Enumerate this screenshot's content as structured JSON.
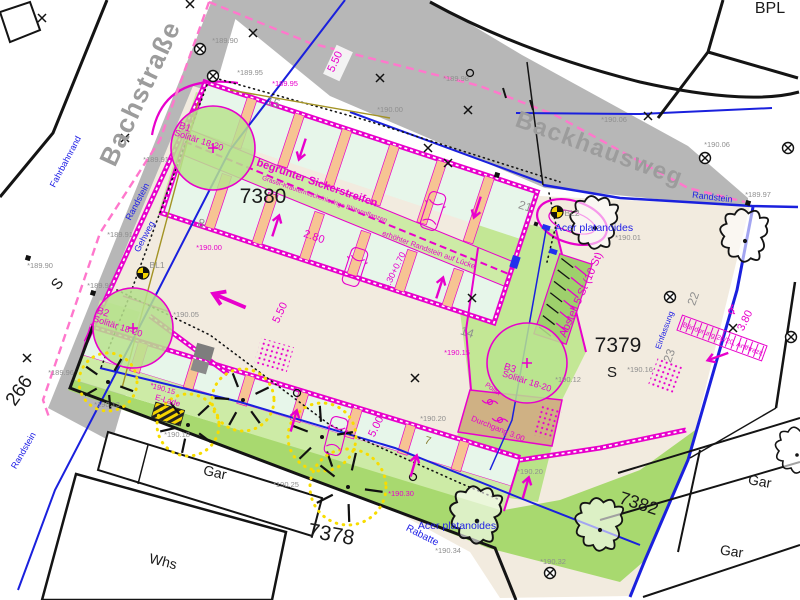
{
  "plan": {
    "colors": {
      "magenta": "#e800cc",
      "pink_boundary": "#ff77cc",
      "blue": "#1a20dd",
      "road_gray": "#b7b7b7",
      "site_beige": "#f2ebdf",
      "green_light": "#cdeba6",
      "green_mid": "#a8d96f",
      "stall_mint": "#e7f6ea",
      "peach": "#f6c493",
      "tan": "#cfb184",
      "tree_yellow": "#f7dc00"
    },
    "labels": {
      "streets": [
        {
          "n": "street-label-bachstrasse",
          "t": "Bachstraße",
          "x": 148,
          "y": 97,
          "r": -65,
          "s": 26
        },
        {
          "n": "street-label-backhausweg",
          "t": "Backhausweg",
          "x": 597,
          "y": 156,
          "r": 20,
          "s": 24
        }
      ],
      "blue_labels": [
        {
          "n": "label-fahrbahnrand",
          "t": "Fahrbahnrand",
          "x": 68,
          "y": 163,
          "r": -62,
          "s": 9
        },
        {
          "n": "label-randstein-left",
          "t": "Randstein",
          "x": 140,
          "y": 203,
          "r": -62,
          "s": 9
        },
        {
          "n": "label-gehweg",
          "t": "Gehweg",
          "x": 147,
          "y": 238,
          "r": -62,
          "s": 9
        },
        {
          "n": "label-randstein-sw",
          "t": "Randstein",
          "x": 26,
          "y": 452,
          "r": -60,
          "s": 9
        },
        {
          "n": "label-randstein-ne",
          "t": "Randstein",
          "x": 712,
          "y": 200,
          "r": 7,
          "s": 9
        },
        {
          "n": "label-rabatte",
          "t": "Rabatte",
          "x": 421,
          "y": 538,
          "r": 27,
          "s": 10
        },
        {
          "n": "label-acer-top",
          "t": "Acer platanoides",
          "x": 594,
          "y": 231,
          "r": 0,
          "s": 10.5
        },
        {
          "n": "label-acer-bottom",
          "t": "Acer platanoides",
          "x": 457,
          "y": 529,
          "r": 0,
          "s": 10.5
        },
        {
          "n": "label-einfassung",
          "t": "Einfassung",
          "x": 667,
          "y": 331,
          "r": -70,
          "s": 8
        }
      ],
      "parcel_labels": [
        {
          "n": "parcel-7380",
          "t": "7380",
          "x": 263,
          "y": 203,
          "r": 0,
          "s": 21
        },
        {
          "n": "parcel-7379",
          "t": "7379",
          "x": 618,
          "y": 352,
          "r": 0,
          "s": 21
        },
        {
          "n": "parcel-7378",
          "t": "7378",
          "x": 330,
          "y": 541,
          "r": 10,
          "s": 21
        },
        {
          "n": "parcel-7382",
          "t": "7382",
          "x": 637,
          "y": 509,
          "r": 18,
          "s": 18
        },
        {
          "n": "label-bpl",
          "t": "BPL",
          "x": 770,
          "y": 13,
          "r": 0,
          "s": 16
        },
        {
          "n": "label-s-7379",
          "t": "S",
          "x": 612,
          "y": 377,
          "r": 0,
          "s": 15
        },
        {
          "n": "label-s-street",
          "t": "S",
          "x": 61,
          "y": 287,
          "r": -50,
          "s": 15
        },
        {
          "n": "parcel-266",
          "t": "266",
          "x": 24,
          "y": 394,
          "r": -55,
          "s": 19
        },
        {
          "n": "building-whs",
          "t": "Whs",
          "x": 162,
          "y": 566,
          "r": 14,
          "s": 14
        },
        {
          "n": "building-gar-1",
          "t": "Gar",
          "x": 214,
          "y": 477,
          "r": 12,
          "s": 14
        },
        {
          "n": "building-gar-2",
          "t": "Gar",
          "x": 759,
          "y": 486,
          "r": 10,
          "s": 14
        },
        {
          "n": "building-gar-3",
          "t": "Gar",
          "x": 731,
          "y": 556,
          "r": 8,
          "s": 14
        }
      ],
      "stall_numbers": [
        {
          "t": "15",
          "x": 272,
          "y": 106,
          "r": 18,
          "s": 12
        },
        {
          "t": "8",
          "x": 200,
          "y": 227,
          "r": 18,
          "s": 12
        },
        {
          "t": "21",
          "x": 524,
          "y": 210,
          "r": 18,
          "s": 12
        },
        {
          "t": "14",
          "x": 466,
          "y": 336,
          "r": 18,
          "s": 12
        },
        {
          "t": "22",
          "x": 697,
          "y": 300,
          "r": -70,
          "s": 12
        },
        {
          "t": "23",
          "x": 673,
          "y": 357,
          "r": -70,
          "s": 12
        },
        {
          "t": "7",
          "x": 427,
          "y": 444,
          "r": 16,
          "s": 11,
          "c": "olive"
        },
        {
          "t": "BL1",
          "x": 157,
          "y": 268,
          "r": 0,
          "s": 8.5
        },
        {
          "t": "BL2",
          "x": 572,
          "y": 216,
          "r": 0,
          "s": 8.5
        }
      ],
      "elevations": [
        {
          "t": "*189.90",
          "x": 225,
          "y": 43
        },
        {
          "t": "*189.95",
          "x": 250,
          "y": 75
        },
        {
          "t": "*189.91",
          "x": 156,
          "y": 162
        },
        {
          "t": "*189.91",
          "x": 120,
          "y": 237
        },
        {
          "t": "*189.90",
          "x": 40,
          "y": 268
        },
        {
          "t": "*189.92",
          "x": 100,
          "y": 288
        },
        {
          "t": "*189.96",
          "x": 61,
          "y": 375
        },
        {
          "t": "*189.98",
          "x": 456,
          "y": 81
        },
        {
          "t": "*190.00",
          "x": 390,
          "y": 112
        },
        {
          "t": "*190.06",
          "x": 614,
          "y": 122
        },
        {
          "t": "*190.06",
          "x": 717,
          "y": 147
        },
        {
          "t": "*189.97",
          "x": 758,
          "y": 197
        },
        {
          "t": "*190.01",
          "x": 628,
          "y": 240
        },
        {
          "t": "*190.05",
          "x": 186,
          "y": 317
        },
        {
          "t": "*190.13",
          "x": 107,
          "y": 407
        },
        {
          "t": "*190.18",
          "x": 177,
          "y": 437
        },
        {
          "t": "*190.25",
          "x": 286,
          "y": 487
        },
        {
          "t": "*190.12",
          "x": 568,
          "y": 382
        },
        {
          "t": "*190.16",
          "x": 640,
          "y": 372
        },
        {
          "t": "*190.20",
          "x": 433,
          "y": 421
        },
        {
          "t": "*190.20",
          "x": 530,
          "y": 474
        },
        {
          "t": "*190.34",
          "x": 448,
          "y": 553
        },
        {
          "t": "*190.32",
          "x": 553,
          "y": 564
        }
      ],
      "magenta_notes": [
        {
          "t": "*189.95",
          "x": 285,
          "y": 86,
          "s": 7.5
        },
        {
          "t": "*190.00",
          "x": 209,
          "y": 250,
          "s": 7.5
        },
        {
          "t": "*190.15",
          "x": 457,
          "y": 355,
          "s": 7.5
        },
        {
          "t": "*190.15",
          "x": 162,
          "y": 391,
          "r": 16,
          "s": 7.5
        },
        {
          "n": "label-e-lade",
          "t": "E-Lade",
          "x": 167,
          "y": 403,
          "r": 16,
          "s": 8
        },
        {
          "t": "*190.30",
          "x": 401,
          "y": 496,
          "s": 7.5
        },
        {
          "n": "label-b1",
          "t": "B1",
          "x": 184,
          "y": 130,
          "r": 18,
          "s": 10
        },
        {
          "t": "Solitär 18-20",
          "x": 198,
          "y": 143,
          "r": 18,
          "s": 9
        },
        {
          "n": "label-b2",
          "t": "B2",
          "x": 102,
          "y": 315,
          "r": 18,
          "s": 10
        },
        {
          "t": "Solitär 18-20",
          "x": 117,
          "y": 329,
          "r": 18,
          "s": 9
        },
        {
          "n": "label-b3",
          "t": "B3",
          "x": 509,
          "y": 371,
          "r": 18,
          "s": 10
        },
        {
          "t": "Solitär 18-20",
          "x": 526,
          "y": 384,
          "r": 18,
          "s": 9
        },
        {
          "n": "label-sickerstreifen",
          "t": "begrünter Sickerstreifen",
          "x": 316,
          "y": 186,
          "r": 19,
          "s": 11,
          "c": "magb"
        },
        {
          "t": "Gräser-Kräutermisch./niedrige Blütenpflanzen",
          "x": 324,
          "y": 201,
          "r": 19,
          "s": 6.5
        },
        {
          "n": "label-randstein-luecke",
          "t": "erhöhter Randstein auf Lücke",
          "x": 428,
          "y": 252,
          "r": 20,
          "s": 7.5
        },
        {
          "t": "5.50",
          "x": 338,
          "y": 63,
          "r": -65,
          "s": 11
        },
        {
          "t": "5.50",
          "x": 283,
          "y": 314,
          "r": -65,
          "s": 11
        },
        {
          "t": "2.80",
          "x": 313,
          "y": 240,
          "r": 19,
          "s": 11
        },
        {
          "t": "4.30+0.70",
          "x": 397,
          "y": 272,
          "r": -64,
          "s": 9
        },
        {
          "t": "5.00",
          "x": 379,
          "y": 428,
          "r": -64,
          "s": 11
        },
        {
          "t": "3.80",
          "x": 748,
          "y": 322,
          "r": -64,
          "s": 11
        },
        {
          "n": "label-baenderung",
          "t": "Bänderung 20/20, Anthrazit",
          "x": 722,
          "y": 341,
          "r": 20,
          "s": 7
        },
        {
          "n": "label-durchgang",
          "t": "Durchgang 3.00",
          "x": 497,
          "y": 431,
          "r": 22,
          "s": 8
        },
        {
          "n": "label-poller",
          "t": "Poller",
          "x": 492,
          "y": 391,
          "r": 35,
          "s": 7
        },
        {
          "n": "label-abstell",
          "t": "Abstell 5 St (10 St)",
          "x": 584,
          "y": 296,
          "r": -66,
          "s": 11
        },
        {
          "n": "disabled-parking-icon",
          "t": "♿",
          "x": 731,
          "y": 314,
          "r": 20,
          "s": 13
        }
      ]
    },
    "symbols": {
      "crosses": [
        [
          190,
          4
        ],
        [
          42,
          18
        ],
        [
          253,
          33
        ],
        [
          380,
          78
        ],
        [
          468,
          110
        ],
        [
          428,
          148
        ],
        [
          448,
          163
        ],
        [
          125,
          138
        ],
        [
          27,
          358
        ],
        [
          415,
          378
        ],
        [
          472,
          298
        ],
        [
          733,
          328
        ],
        [
          648,
          116
        ]
      ],
      "survey_circles": [
        [
          200,
          49
        ],
        [
          213,
          76
        ],
        [
          705,
          158
        ],
        [
          788,
          148
        ],
        [
          670,
          297
        ],
        [
          791,
          337
        ],
        [
          550,
          573
        ]
      ],
      "valve_wheels": [
        [
          143,
          273
        ],
        [
          557,
          212
        ]
      ],
      "point_squares": [
        [
          28,
          258
        ],
        [
          748,
          203
        ],
        [
          497,
          175
        ],
        [
          93,
          293
        ]
      ],
      "open_circles": [
        [
          470,
          73
        ],
        [
          297,
          393
        ],
        [
          413,
          477
        ]
      ],
      "arrows": [
        {
          "x": 302,
          "y": 150,
          "r": 198
        },
        {
          "x": 477,
          "y": 208,
          "r": 198
        },
        {
          "x": 276,
          "y": 225,
          "r": 18
        },
        {
          "x": 440,
          "y": 287,
          "r": 18
        },
        {
          "x": 294,
          "y": 420,
          "r": 16
        },
        {
          "x": 414,
          "y": 465,
          "r": 16
        },
        {
          "x": 526,
          "y": 487,
          "r": 16
        },
        {
          "x": 228,
          "y": 300,
          "r": -67,
          "sc": 1.6
        },
        {
          "x": 717,
          "y": 357,
          "r": 250
        }
      ],
      "cars": [
        {
          "x": 433,
          "y": 211,
          "r": 18
        },
        {
          "x": 355,
          "y": 267,
          "r": 18
        },
        {
          "x": 336,
          "y": 436,
          "r": 14
        }
      ],
      "trees_black": [
        {
          "x": 595,
          "y": 228,
          "sc": 1.15
        },
        {
          "x": 745,
          "y": 241,
          "sc": 1.15
        },
        {
          "x": 600,
          "y": 530,
          "sc": 1.15
        },
        {
          "x": 477,
          "y": 521,
          "sc": 1.25
        },
        {
          "x": 797,
          "y": 455,
          "sc": 1.0
        }
      ],
      "trees_existing_yellow": [
        {
          "x": 108,
          "y": 382,
          "rad": 29
        },
        {
          "x": 188,
          "y": 425,
          "rad": 31
        },
        {
          "x": 243,
          "y": 400,
          "rad": 31
        },
        {
          "x": 322,
          "y": 437,
          "rad": 34
        },
        {
          "x": 348,
          "y": 487,
          "rad": 38
        }
      ],
      "planting_circles": [
        {
          "n": "planting-b1",
          "x": 213,
          "y": 148,
          "rad": 42
        },
        {
          "n": "planting-b2",
          "x": 133,
          "y": 328,
          "rad": 40
        },
        {
          "n": "planting-b3",
          "x": 527,
          "y": 363,
          "rad": 40
        }
      ],
      "bollards": [
        [
          490,
          402
        ],
        [
          500,
          420
        ]
      ]
    }
  }
}
